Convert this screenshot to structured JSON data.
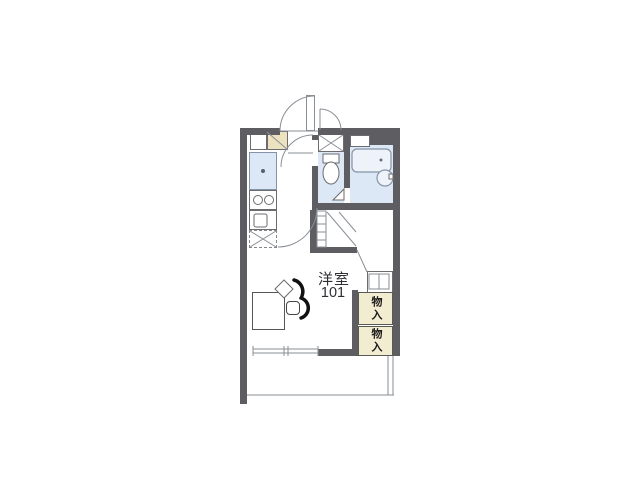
{
  "floorplan": {
    "room_label": "洋室",
    "room_number": "101",
    "storage_upper_label": "物入",
    "storage_lower_label": "物入",
    "colors": {
      "wall": "#5e5e62",
      "water_floor": "#dce8f5",
      "fixture_border": "#8593a8",
      "storage_fill": "#f2ecd0",
      "storage_border": "#5a5a54",
      "cream_cabinet": "#ece2bf",
      "line": "#8a8f96",
      "furniture_black": "#111111",
      "text": "#2f2f33"
    }
  }
}
